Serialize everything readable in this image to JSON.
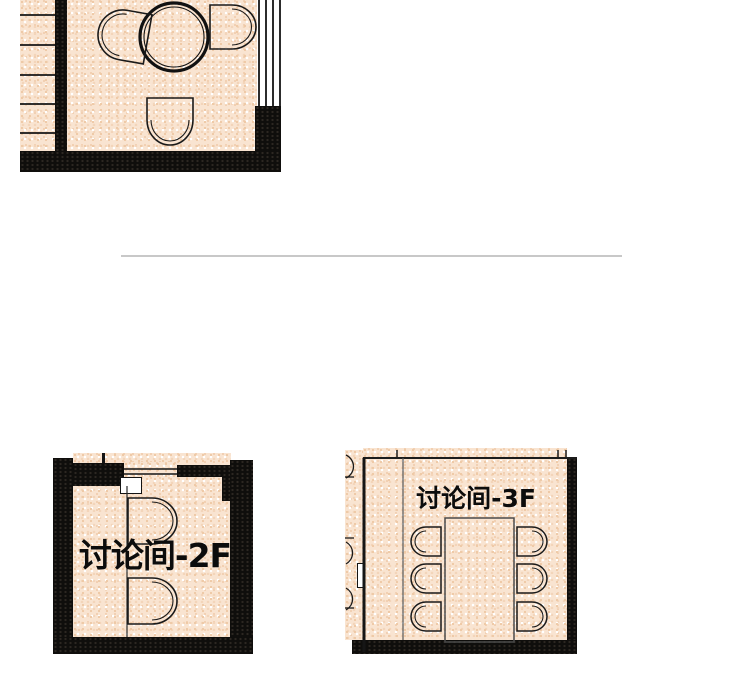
{
  "floorplans": {
    "top_partial": {
      "label": ""
    },
    "room_2f": {
      "label": "讨论间-2F"
    },
    "room_3f": {
      "label": "讨论间-3F"
    }
  },
  "colors": {
    "floor": "#f9e4d1",
    "floor_speckle": "#eec9a6",
    "wall": "#0f0e0c",
    "outline": "#1a1a1a",
    "divider": "#c8c8c8",
    "background": "#ffffff"
  }
}
